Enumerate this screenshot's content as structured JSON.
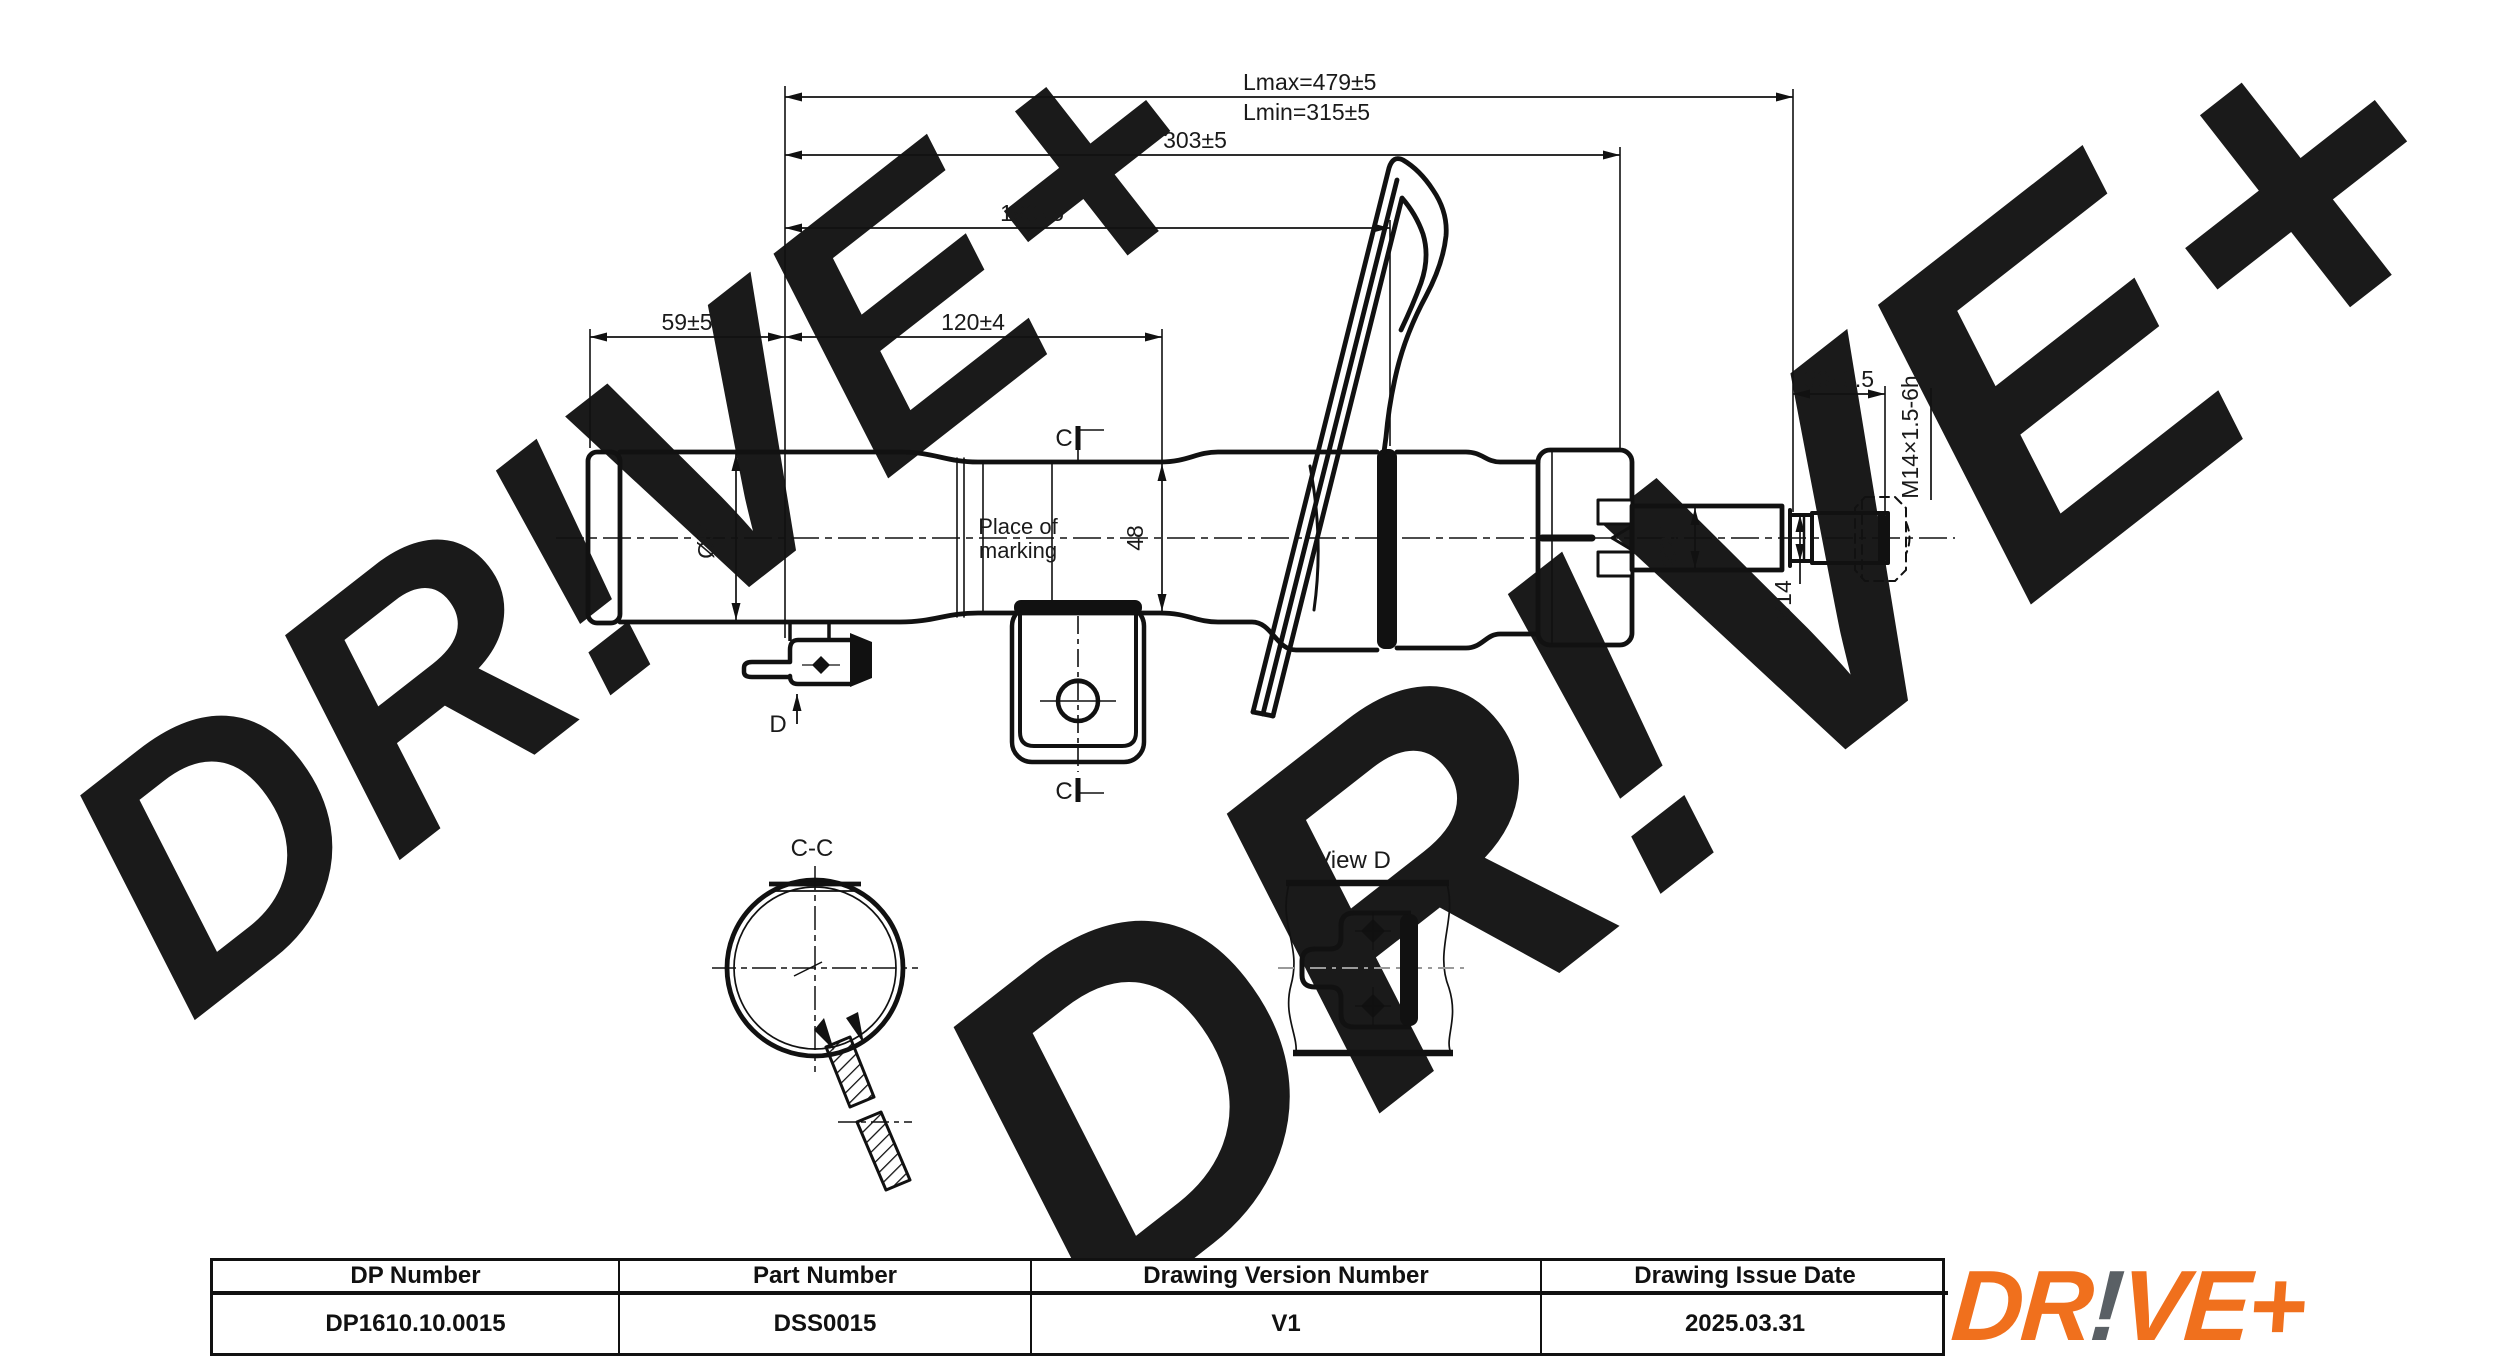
{
  "watermark": {
    "text": "DR!VE+"
  },
  "drawing": {
    "dimensions": {
      "lmax": "Lmax=479±5",
      "lmin": "Lmin=315±5",
      "overall_303": "303±5",
      "mid_190": "190±5",
      "left_59": "59±5",
      "left_120": "120±4",
      "body_dia_51": "Ø51",
      "body_dia_48": "48",
      "rod_dia_20": "Ø20",
      "rod_dia_14": "Ø14",
      "thread_len_30": "30±0.5",
      "thread_spec": "M14×1.5-6h"
    },
    "annotations": {
      "marking_line1": "Place of",
      "marking_line2": "marking",
      "section_letter_top": "C",
      "section_letter_bottom": "C",
      "view_letter": "D",
      "section_title": "C-C",
      "view_title": "View D"
    }
  },
  "table": {
    "columns": [
      {
        "header": "DP Number",
        "value": "DP1610.10.0015"
      },
      {
        "header": "Part Number",
        "value": "DSS0015"
      },
      {
        "header": "Drawing Version Number",
        "value": "V1"
      },
      {
        "header": "Drawing Issue Date",
        "value": "2025.03.31"
      }
    ]
  },
  "logo": {
    "part1": "DR",
    "bang": "!",
    "part2": "VE+",
    "orange": "#F0701D",
    "gray": "#5A6065"
  }
}
